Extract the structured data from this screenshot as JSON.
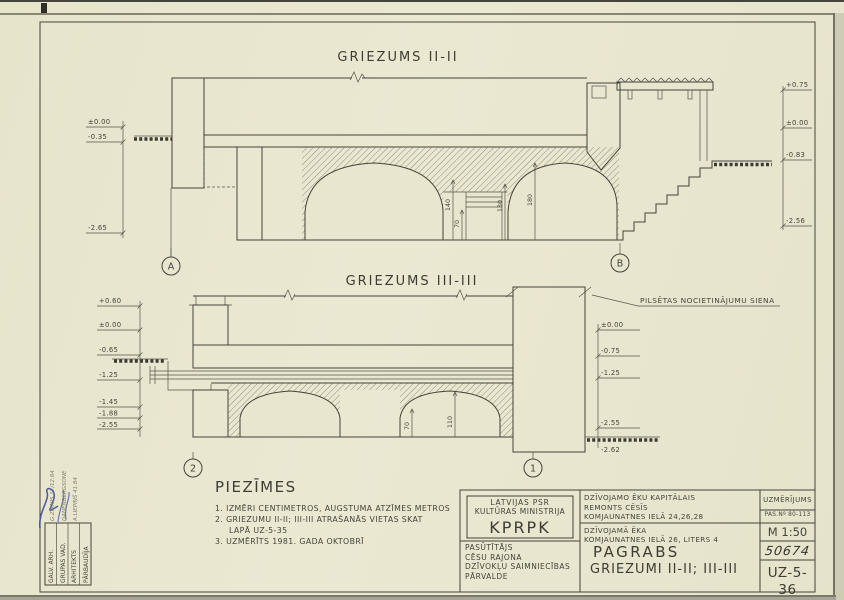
{
  "sections": [
    {
      "id": "II-II",
      "title": "GRIEZUMS II-II",
      "axis_markers": [
        "A",
        "B"
      ],
      "left_marks": [
        "±0.00",
        "-0.35",
        "-2.65"
      ],
      "right_marks": [
        "+0.75",
        "±0.00",
        "-0.83",
        "-2.56"
      ],
      "dimensions": [
        "140",
        "70",
        "130",
        "180"
      ]
    },
    {
      "id": "III-III",
      "title": "GRIEZUMS III-III",
      "wall_label": "PILSĒTAS NOCIETINĀJUMU SIENA",
      "axis_markers": [
        "2",
        "1"
      ],
      "left_marks": [
        "+0.60",
        "±0.00",
        "-0.65",
        "-1.25",
        "-1.45",
        "-1.88",
        "-2.55"
      ],
      "right_marks": [
        "±0.00",
        "-0.75",
        "-1.25",
        "-2.55",
        "-2.62"
      ],
      "dimensions": [
        "70",
        "110"
      ]
    }
  ],
  "notes": {
    "title": "PIEZĪMES",
    "lines": [
      "1. IZMĒRI CENTIMETROS, AUGSTUMA ATZĪMES METROS",
      "2. GRIEZUMU II-II; III-III ATRAŠANĀS VIETAS SKAT",
      "LAPĀ UZ-5-35",
      "3. UZMĒRĪTS 1981. GADA OKTOBRĪ"
    ]
  },
  "title_block": {
    "ministry_line1": "LATVIJAS PSR",
    "ministry_line2": "KULTŪRAS MINISTRIJA",
    "org": "KPRPK",
    "client_label": "PASŪTĪTĀJS",
    "client_line1": "CĒSU RAJONA",
    "client_line2": "DZĪVOKĻU SAIMNIECĪBAS",
    "client_line3": "PĀRVALDE",
    "project_line1": "DZĪVOJAMO ĒKU KAPITĀLAIS",
    "project_line2": "REMONTS CĒSĪS",
    "project_line3": "KOMJAUNATNES IELĀ 24,26,28",
    "object_line1": "DZĪVOJAMĀ ĒKA",
    "object_line2": "KOMJAUNATNES IELĀ 26, LITERS 4",
    "drawing_title1": "PAGRABS",
    "drawing_title2": "GRIEZUMI II-II; III-III",
    "survey_type": "UZMĒRĪJUMS",
    "order_no": "PAS.Nº 80-113",
    "scale": "M 1:50",
    "archive_no": "50674",
    "sheet_no": "UZ-5-36"
  },
  "signature_block": {
    "rows": [
      {
        "label": "GALV. ARH.",
        "entry": "G.ZIRNIS 17/12.84"
      },
      {
        "label": "GRUPAS VAD.",
        "entry": "DANENBERGSONE"
      },
      {
        "label": "ARHITEKTS",
        "entry": "A.LIEPIŅŠ 41.84"
      },
      {
        "label": "PĀRBAUDĪJA",
        "entry": ""
      }
    ]
  },
  "colors": {
    "paper": "#e9e6cf",
    "ink": "#45433a",
    "signature_blue": "#3d4f9e",
    "pencil": "#827e6c"
  }
}
